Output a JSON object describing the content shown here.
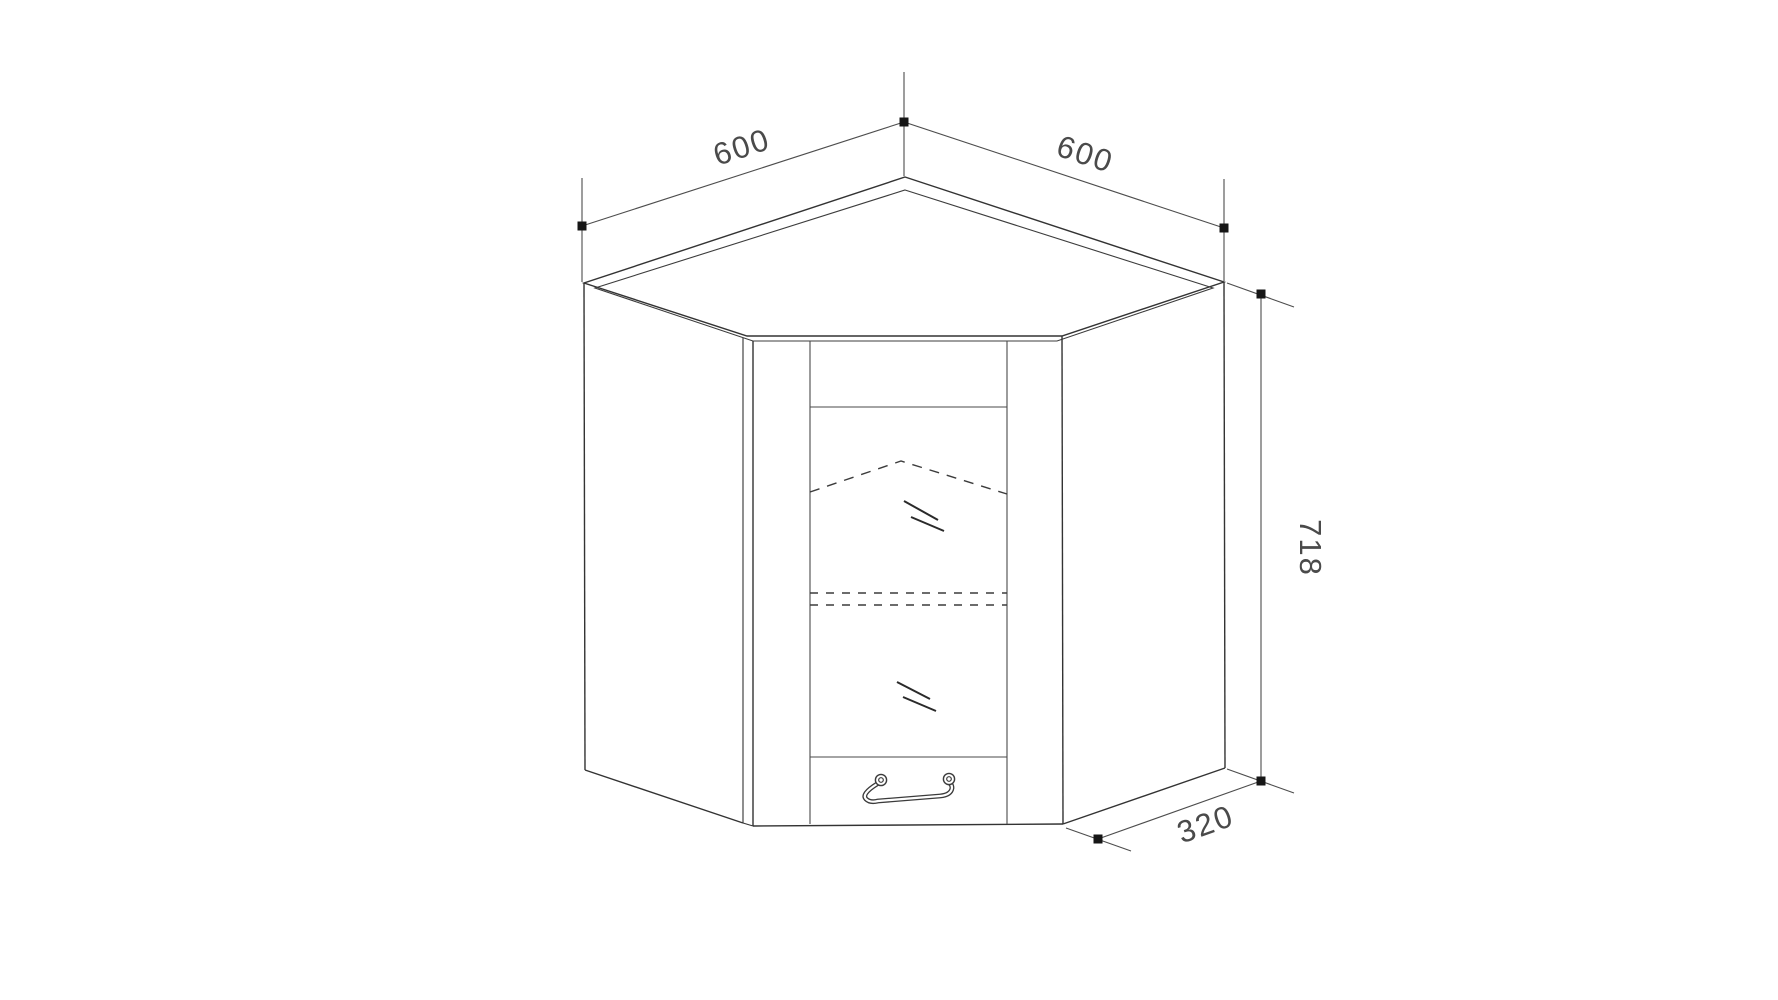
{
  "colors": {
    "background": "#ffffff",
    "cabinet_line": "#333333",
    "detail_line": "#4a4a4a",
    "dimension_line": "#4d4d4d",
    "marker": "#161616",
    "label_text": "#4a4a4a"
  },
  "dimensions": {
    "left_width": "600",
    "right_width": "600",
    "height": "718",
    "depth": "320"
  }
}
